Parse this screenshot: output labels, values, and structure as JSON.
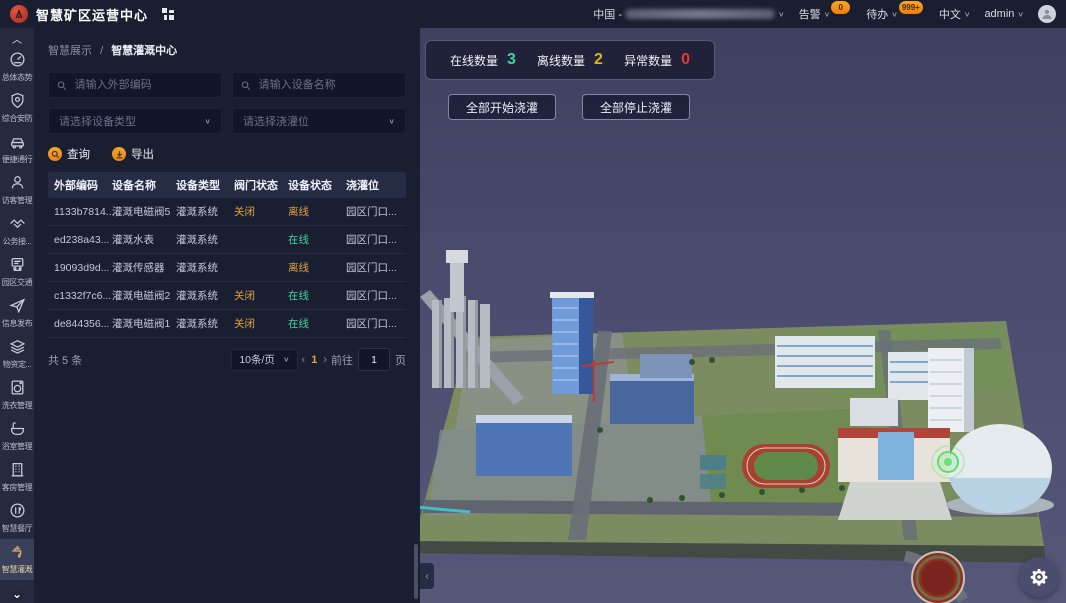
{
  "header": {
    "title": "智慧矿区运营中心",
    "region_label": "中国 -",
    "alarm_label": "告警",
    "alarm_count": "0",
    "todo_label": "待办",
    "todo_count": "999+",
    "lang_label": "中文",
    "user_name": "admin"
  },
  "sidebar": {
    "items": [
      {
        "label": "总体态势",
        "icon": "gauge-icon"
      },
      {
        "label": "综合安防",
        "icon": "shield-icon"
      },
      {
        "label": "便捷通行",
        "icon": "car-icon"
      },
      {
        "label": "访客管理",
        "icon": "visitor-icon"
      },
      {
        "label": "公务接...",
        "icon": "handshake-icon"
      },
      {
        "label": "园区交通",
        "icon": "traffic-icon"
      },
      {
        "label": "信息发布",
        "icon": "send-icon"
      },
      {
        "label": "物资定...",
        "icon": "layers-icon"
      },
      {
        "label": "洗衣管理",
        "icon": "washer-icon"
      },
      {
        "label": "浴室管理",
        "icon": "bath-icon"
      },
      {
        "label": "客房管理",
        "icon": "building-icon"
      },
      {
        "label": "智慧餐厅",
        "icon": "dining-icon"
      },
      {
        "label": "智慧灌溉",
        "icon": "faucet-icon"
      }
    ]
  },
  "panel": {
    "breadcrumb_parent": "智慧展示",
    "breadcrumb_current": "智慧灌溉中心",
    "search_code_placeholder": "请输入外部编码",
    "search_name_placeholder": "请输入设备名称",
    "select_type_placeholder": "请选择设备类型",
    "select_location_placeholder": "请选择浇灌位",
    "query_label": "查询",
    "export_label": "导出",
    "table": {
      "columns": [
        "外部编码",
        "设备名称",
        "设备类型",
        "阀门状态",
        "设备状态",
        "浇灌位"
      ],
      "rows": [
        {
          "code": "1133b7814...",
          "name": "灌溉电磁阀5",
          "type": "灌溉系统",
          "valve": "关闭",
          "status": "离线",
          "status_type": "offline",
          "location": "园区门口..."
        },
        {
          "code": "ed238a43...",
          "name": "灌溉水表",
          "type": "灌溉系统",
          "valve": "",
          "status": "在线",
          "status_type": "online",
          "location": "园区门口..."
        },
        {
          "code": "19093d9d...",
          "name": "灌溉传感器",
          "type": "灌溉系统",
          "valve": "",
          "status": "离线",
          "status_type": "offline",
          "location": "园区门口..."
        },
        {
          "code": "c1332f7c6...",
          "name": "灌溉电磁阀2",
          "type": "灌溉系统",
          "valve": "关闭",
          "status": "在线",
          "status_type": "online",
          "location": "园区门口..."
        },
        {
          "code": "de844356...",
          "name": "灌溉电磁阀1",
          "type": "灌溉系统",
          "valve": "关闭",
          "status": "在线",
          "status_type": "online",
          "location": "园区门口..."
        }
      ]
    },
    "pagination": {
      "total": "共 5 条",
      "page_size": "10条/页",
      "prev": "‹",
      "current_page": "1",
      "next": "›",
      "goto_label": "前往",
      "goto_value": "1",
      "page_unit": "页"
    }
  },
  "overlay": {
    "stats": [
      {
        "label": "在线数量",
        "value": "3",
        "color": "#3ed3a3"
      },
      {
        "label": "离线数量",
        "value": "2",
        "color": "#d8b424"
      },
      {
        "label": "异常数量",
        "value": "0",
        "color": "#e23d30"
      }
    ],
    "start_all_label": "全部开始浇灌",
    "stop_all_label": "全部停止浇灌"
  }
}
